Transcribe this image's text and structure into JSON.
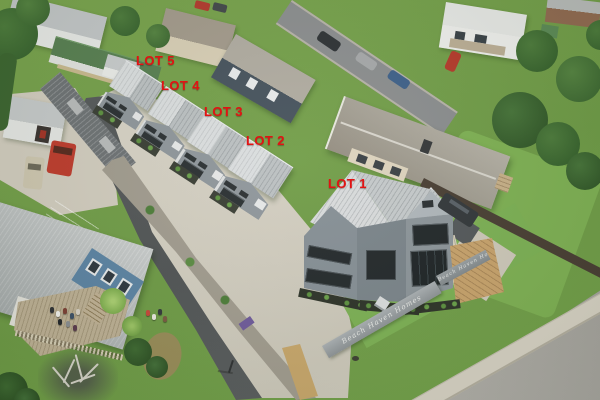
{
  "annotations": {
    "label_color": "#e21313",
    "lots": [
      {
        "id": "lot-1",
        "label": "LOT 1",
        "x": 328,
        "y": 176
      },
      {
        "id": "lot-2",
        "label": "LOT 2",
        "x": 246,
        "y": 133
      },
      {
        "id": "lot-3",
        "label": "LOT 3",
        "x": 204,
        "y": 104
      },
      {
        "id": "lot-4",
        "label": "LOT 4",
        "x": 161,
        "y": 78
      },
      {
        "id": "lot-5",
        "label": "LOT 5",
        "x": 136,
        "y": 53
      }
    ]
  },
  "scene": {
    "type": "aerial-photograph",
    "subject": "Five-lot townhouse development with red lot number labels, neighbouring houses, streets and driveway",
    "fence_script": "Beach Haven Homes",
    "palette": {
      "lawn_green": "#76a44c",
      "roof_grey": "#ccd0d2",
      "cladding_grey": "#8f969c",
      "courtyard_concrete": "#d6d1c5",
      "driveway_asphalt": "#56595b",
      "road": "#a5a29d",
      "blue_house_wall": "#5d84a5",
      "red_van": "#bf3b2d"
    }
  }
}
